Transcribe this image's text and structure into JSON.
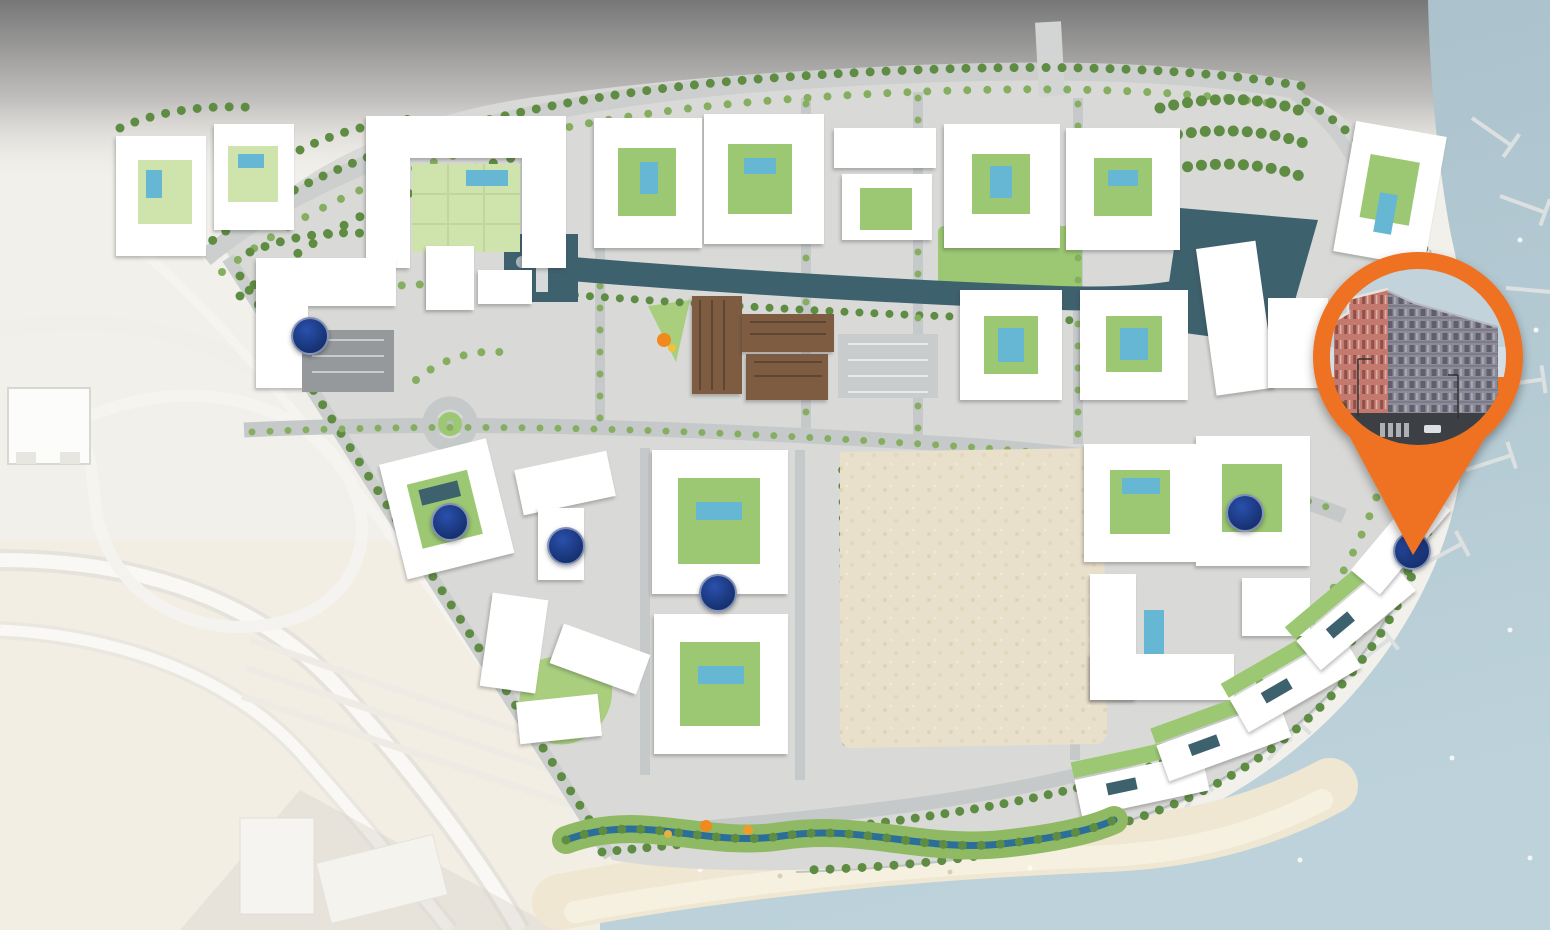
{
  "meta": {
    "map_type": "master-plan-aerial-site-map",
    "description": "Rendered master plan of a waterfront mixed-use community with six building location markers and one highlighted building pin"
  },
  "palette": {
    "base_land": "#F2F0EB",
    "top_fade_dark": "#777777",
    "sea": "#A7BEC9",
    "sea_light": "#BDD2DA",
    "beach_sand": "#EFE7D2",
    "beach_sand_light": "#F6F0E0",
    "vacant_lot_sand": "#E9E0CB",
    "pavement": "#D9DAD7",
    "road": "#C6C9C9",
    "canal": "#3E616E",
    "creek": "#2B6E9A",
    "pool": "#66B7D4",
    "lawn_light": "#CFE3AD",
    "lawn": "#9CC873",
    "tree_dark": "#5F8C43",
    "tree_light": "#86AE60",
    "building_white": "#FFFFFF",
    "retail_brown": "#7D5C42",
    "parking_dark": "#96999B",
    "pier": "#DCE0E0",
    "marker_blue": "#16306F",
    "marker_blue_light": "#2A50AC",
    "pin_orange": "#EF7123",
    "photo_sky": "#C3D3DB",
    "photo_building_pink": "#C4796F",
    "photo_building_gray": "#8C8B97",
    "photo_street": "#3C3F44",
    "playground_orange": "#F08A1D"
  },
  "markers": [
    {
      "id": 1,
      "x": 310,
      "y": 336
    },
    {
      "id": 2,
      "x": 450,
      "y": 522
    },
    {
      "id": 3,
      "x": 566,
      "y": 546
    },
    {
      "id": 4,
      "x": 718,
      "y": 593
    },
    {
      "id": 5,
      "x": 1245,
      "y": 513
    },
    {
      "id": 6,
      "x": 1412,
      "y": 551
    }
  ],
  "marker_diameter": 38,
  "pin": {
    "cx": 1418,
    "cy": 357,
    "head_r": 105,
    "photo_r": 88,
    "tip_x": 1413,
    "tip_y": 555
  }
}
